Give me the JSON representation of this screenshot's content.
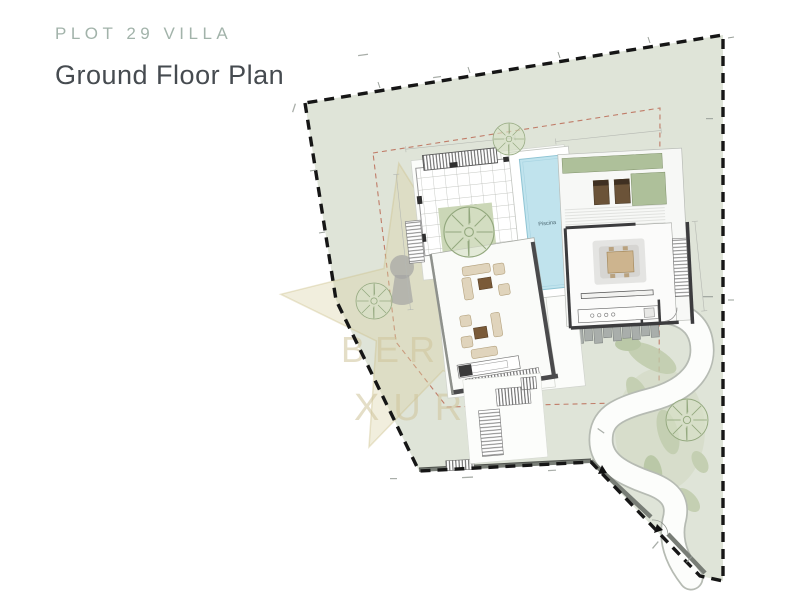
{
  "header": {
    "plot_label": "PLOT 29 VILLA",
    "title": "Ground Floor Plan"
  },
  "plan": {
    "pool_label": "Piscina",
    "watermark_fragments": {
      "f1": "BER",
      "f2": "R",
      "f3": "XURY"
    },
    "colors": {
      "title_accent": "#a2b3aa",
      "title_dark": "#464b50",
      "site_green": "#dfe4d8",
      "courtyard_green": "#cbd7b7",
      "planter_green": "#aec09a",
      "pool_blue": "#c0e3ed",
      "boundary_black": "#161616",
      "setback_red": "#bb6a55",
      "wall_gray": "#787d76",
      "watermark_beige": "#d9cda4"
    }
  }
}
